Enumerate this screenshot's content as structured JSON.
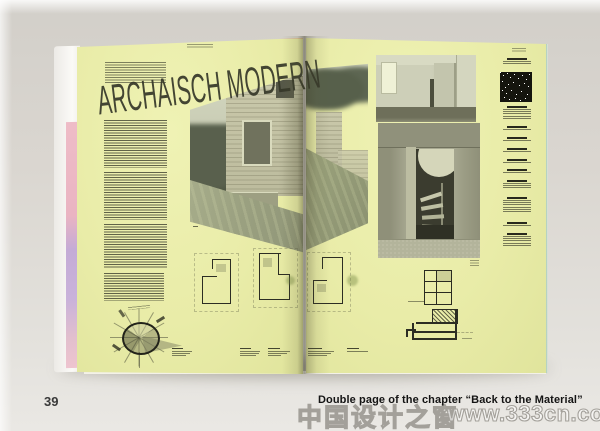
{
  "spread": {
    "headline": "ARCHAISCH MODERN"
  },
  "footer": {
    "page_number": "39",
    "caption": "Double page of the chapter “Back to the Material”"
  },
  "watermark": {
    "site_name_cn": "中国设计之窗",
    "site_url": "www.333cn.com"
  },
  "colors": {
    "backdrop": "#dbd7d1",
    "page_yellow": "#e9eca8",
    "ink": "#3e4033",
    "edge_pink": "#eab9c6",
    "edge_lavender": "#c2a9d5",
    "edge_teal": "#bdd8c9",
    "caption_ink": "#141414",
    "watermark_outline": "#a3a09a"
  }
}
